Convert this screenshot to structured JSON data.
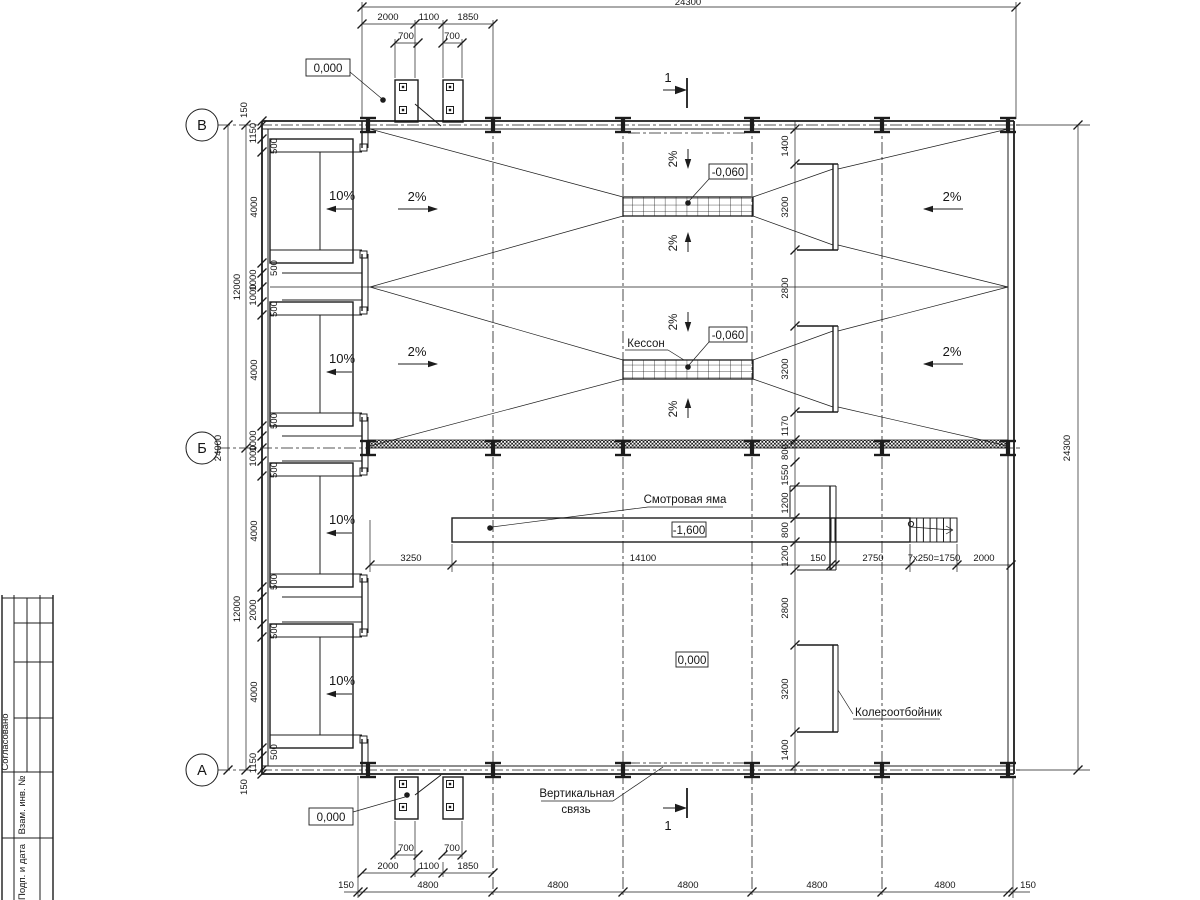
{
  "axes": {
    "top": "В",
    "middle": "Б",
    "bottom": "А"
  },
  "labels": {
    "kesson": "Кессон",
    "inspection_pit": "Смотровая яма",
    "vertical_brace_line1": "Вертикальная",
    "vertical_brace_line2": "связь",
    "wheel_stop": "Колесоотбойник",
    "elev_zero": "0,000",
    "elev_minus_060": "-0,060",
    "elev_minus_1600": "-1,600",
    "section_number": "1",
    "slope_10": "10%",
    "slope_2": "2%"
  },
  "dims": {
    "d24300": "24300",
    "d24000": "24000",
    "d12000": "12000",
    "d14100": "14100",
    "d4800": "4800",
    "d4000": "4000",
    "d3250": "3250",
    "d3200": "3200",
    "d2800": "2800",
    "d2750": "2750",
    "d2000": "2000",
    "d1850": "1850",
    "d1550": "1550",
    "d1400": "1400",
    "d1200": "1200",
    "d1170": "1170",
    "d1150": "1150",
    "d1100": "1100",
    "d1000": "1000",
    "d800": "800",
    "d700": "700",
    "d500": "500",
    "d150": "150",
    "dstair": "7х250=1750"
  },
  "titleblock": {
    "agreed": "Согласовано",
    "zam_inv": "Взам. инв. №",
    "podp_data": "Подп. и дата"
  }
}
